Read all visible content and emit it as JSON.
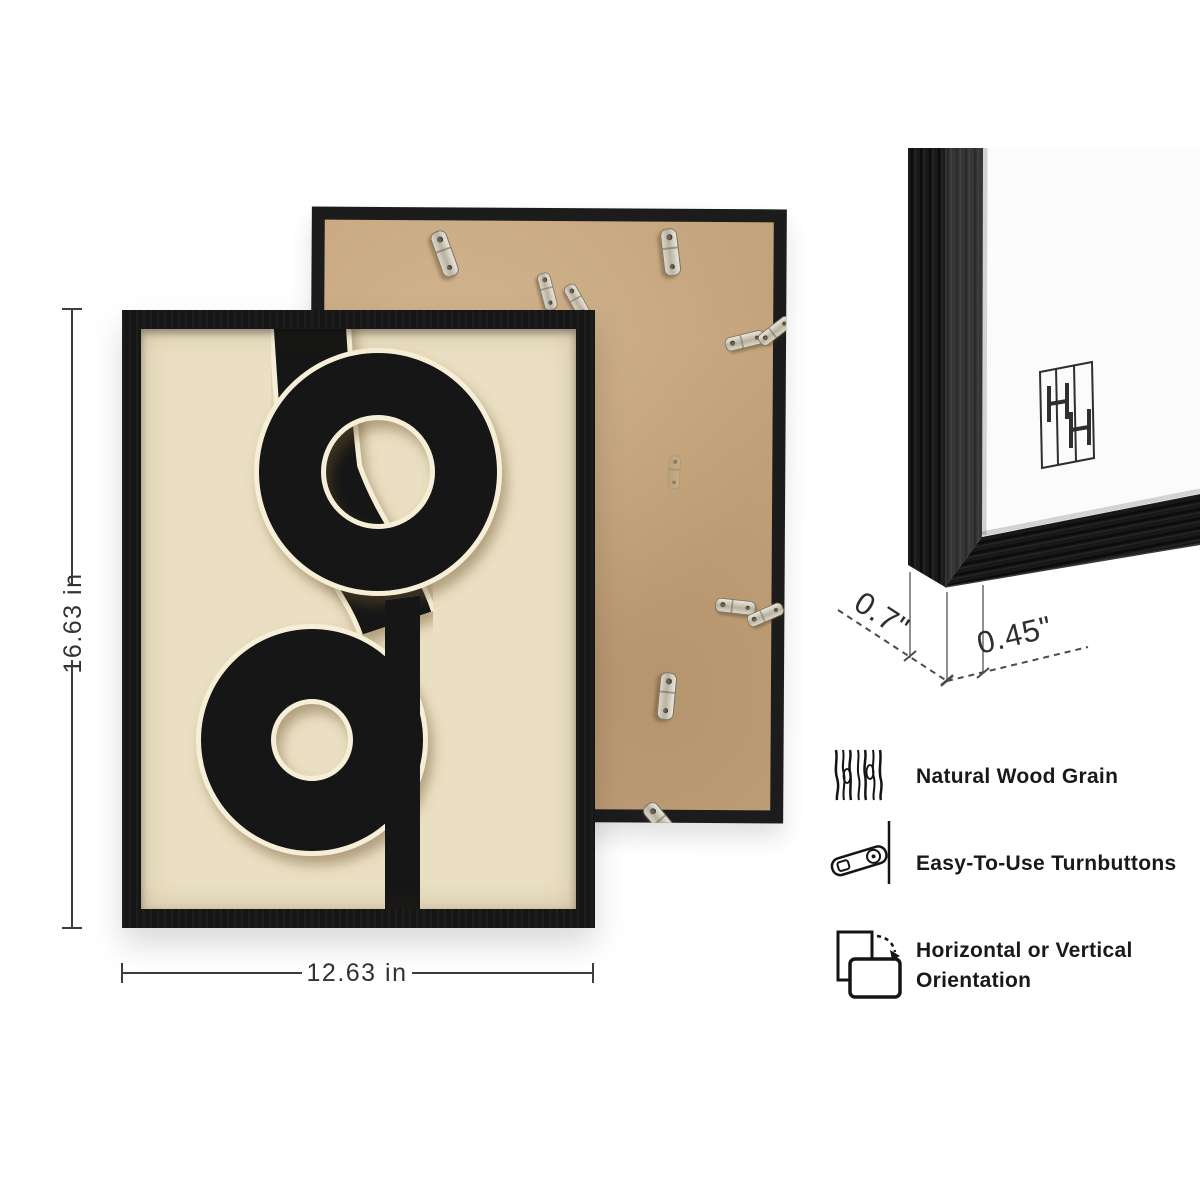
{
  "dimensions": {
    "height": "16.63 in",
    "width": "12.63 in",
    "depth": "0.7\"",
    "moulding_width": "0.45\""
  },
  "features": [
    {
      "icon": "wood-grain-icon",
      "label": "Natural Wood Grain"
    },
    {
      "icon": "turnbutton-icon",
      "label": "Easy-To-Use Turnbuttons"
    },
    {
      "icon": "orientation-icon",
      "label": "Horizontal or Vertical",
      "label2": "Orientation"
    }
  ],
  "colors": {
    "frame": "#161616",
    "art_background": "#EADFC2",
    "kraft_back": "#C3A37C",
    "mat_white": "#FBFBFB"
  }
}
